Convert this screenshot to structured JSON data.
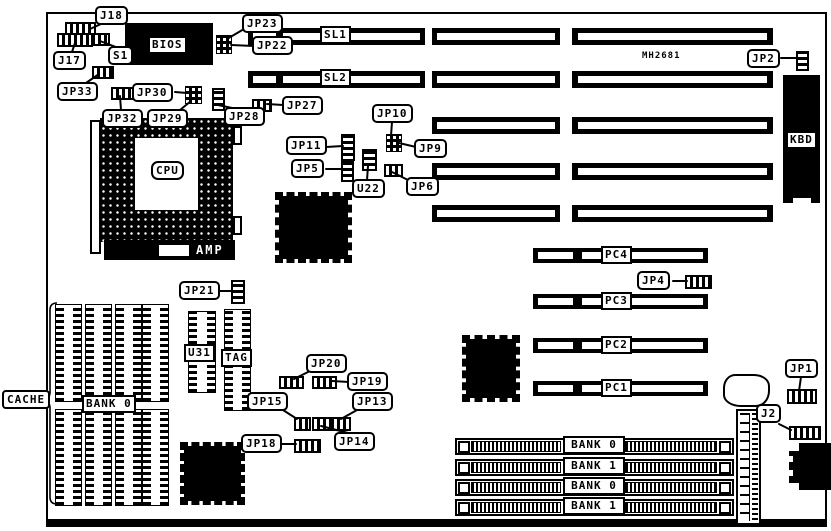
{
  "colors": {
    "ink": "#000000",
    "paper": "#ffffff"
  },
  "labels": {
    "j18": "J18",
    "j17": "J17",
    "s1": "S1",
    "bios": "BIOS",
    "jp33": "JP33",
    "jp30": "JP30",
    "jp32": "JP32",
    "jp29": "JP29",
    "jp28": "JP28",
    "jp27": "JP27",
    "jp23": "JP23",
    "jp22": "JP22",
    "sl1": "SL1",
    "sl2": "SL2",
    "mh2681": "MH2681",
    "jp2": "JP2",
    "kbd": "KBD",
    "cpu": "CPU",
    "amp": "AMP",
    "jp10": "JP10",
    "jp11": "JP11",
    "jp9": "JP9",
    "jp5": "JP5",
    "u22": "U22",
    "jp6": "JP6",
    "jp21": "JP21",
    "u31": "U31",
    "tag": "TAG",
    "jp20": "JP20",
    "jp19": "JP19",
    "jp15": "JP15",
    "jp13": "JP13",
    "jp14": "JP14",
    "jp18": "JP18",
    "cache": "CACHE",
    "cache_bank": "BANK 0",
    "pc4": "PC4",
    "pc3": "PC3",
    "pc2": "PC2",
    "pc1": "PC1",
    "jp4": "JP4",
    "jp1": "JP1",
    "j2": "J2"
  },
  "simm": {
    "banks": [
      "BANK 0",
      "BANK 1",
      "BANK 0",
      "BANK 1"
    ]
  }
}
